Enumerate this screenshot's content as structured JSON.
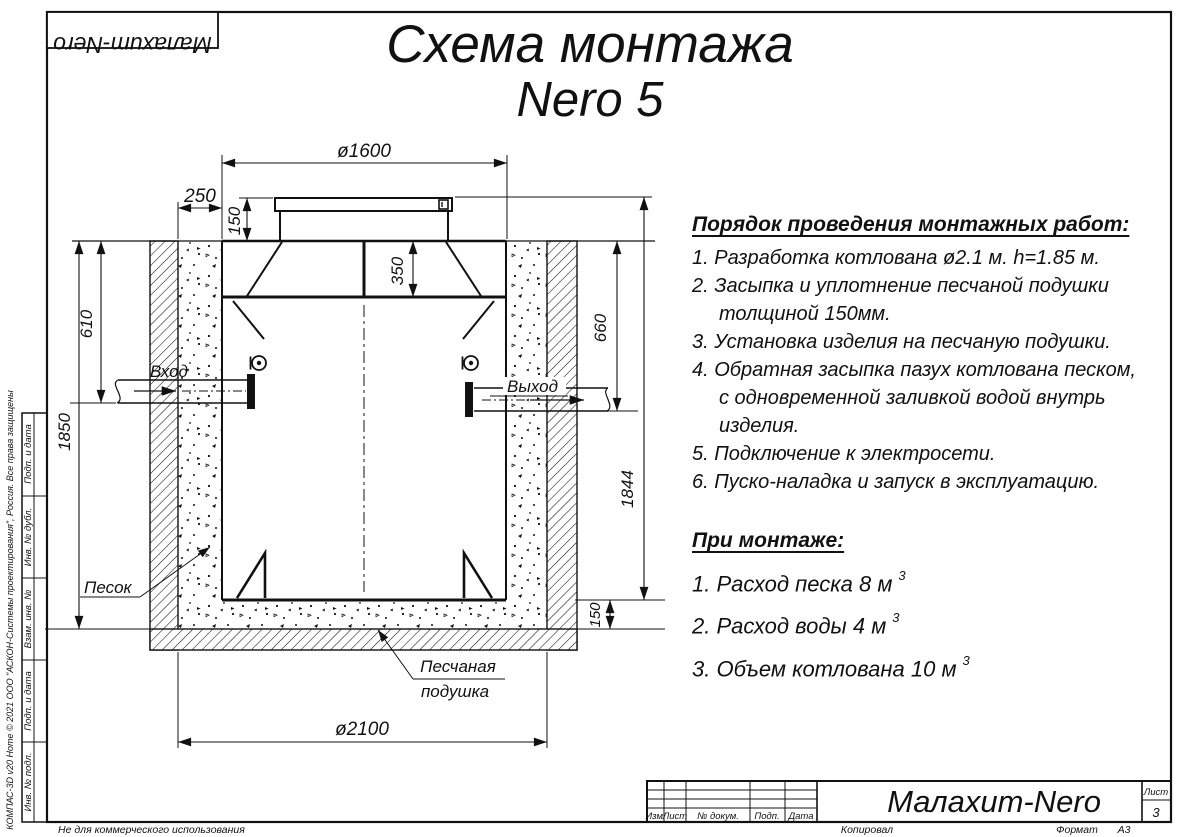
{
  "sheet": {
    "logo": "Малахит-Nero",
    "title_line1": "Схема монтажа",
    "title_line2": "Nero 5"
  },
  "instructions": {
    "heading": "Порядок проведения монтажных работ:",
    "steps": [
      "1. Разработка котлована ø2.1 м. h=1.85 м.",
      "2. Засыпка и уплотнение песчаной подушки\nтолщиной 150мм.",
      "3. Установка изделия на песчаную подушки.",
      "4. Обратная засыпка пазух котлована песком,\nс одновременной заливкой водой внутрь\nизделия.",
      "5. Подключение к электросети.",
      "6. Пуско-наладка и запуск в эксплуатацию."
    ]
  },
  "montage": {
    "heading": "При монтаже:",
    "items": [
      {
        "text": "1. Расход песка 8 м",
        "sup": "3"
      },
      {
        "text": "2. Расход воды 4 м",
        "sup": "3"
      },
      {
        "text": "3. Объем котлована 10 м",
        "sup": "3"
      }
    ]
  },
  "drawing": {
    "dims": {
      "top_diameter": "ø1600",
      "backfill_width": "250",
      "lid_height": "150",
      "neck_depth": "350",
      "inlet_depth": "610",
      "pit_depth": "1850",
      "outlet_depth": "660",
      "tank_height": "1844",
      "cushion_height": "150",
      "pit_diameter": "ø2100"
    },
    "labels": {
      "inlet": "Вход",
      "outlet": "Выход",
      "sand": "Песок",
      "cushion_line1": "Песчаная",
      "cushion_line2": "подушка"
    }
  },
  "title_block": {
    "cols": [
      "Изм.",
      "Лист",
      "№ докум.",
      "Подп.",
      "Дата"
    ],
    "company": "Малахит-Nero",
    "sheet_label": "Лист",
    "sheet_number": "3",
    "copied": "Копировал",
    "format_label": "Формат",
    "format_value": "А3"
  },
  "side_stamp": {
    "cells": [
      "Подп. и дата",
      "Инв. № дубл.",
      "Взам. инв. №",
      "Подп. и дата",
      "Инв. № подл."
    ],
    "copyright": "КОМПАС-3D v20 Home © 2021 ООО \"АСКОН-Системы проектирования\", Россия. Все права защищены",
    "notice": "Не для коммерческого использования"
  }
}
